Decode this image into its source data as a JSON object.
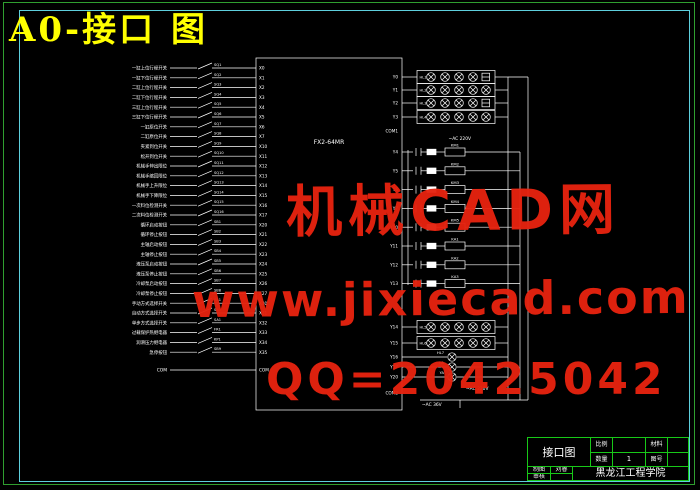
{
  "title": "A0-接口 图",
  "watermarks": {
    "line1": "机械CAD网",
    "line2": "www.jixiecad.com",
    "line3": "QQ=20425042"
  },
  "colors": {
    "border_outer": "#2f9e2f",
    "border_inner": "#5ecfdd",
    "title_yellow": "#ffff00",
    "schematic_white": "#ffffff",
    "watermark_red": "#e6230f",
    "titleblock_green": "#18c818"
  },
  "title_block": {
    "drawing_name": "接口图",
    "scale_label": "比例",
    "scale_value": "",
    "qty_label": "数量",
    "qty_value": "1",
    "material_label": "材料",
    "material_value": "",
    "dwgno_label": "图号",
    "dwgno_value": "",
    "drawn_label": "制图",
    "drawn_by": "刘睿",
    "checked_label": "审核",
    "school": "黑龙江工程学院"
  },
  "schematic": {
    "plc_model": "FX2-64MR",
    "com_input": "COM",
    "com_right_top": "COM1",
    "com_right_bottom": "COM2",
    "power_top": "~AC 220V",
    "power_mid": "~AC 220V",
    "power_bottom": "~AC 36V",
    "inputs": [
      {
        "label": "一缸上位行程开关",
        "dev": "SQ1",
        "pin": "X0"
      },
      {
        "label": "一缸下位行程开关",
        "dev": "SQ2",
        "pin": "X1"
      },
      {
        "label": "二缸上位行程开关",
        "dev": "SQ3",
        "pin": "X2"
      },
      {
        "label": "二缸下位行程开关",
        "dev": "SQ4",
        "pin": "X3"
      },
      {
        "label": "三缸上位行程开关",
        "dev": "SQ5",
        "pin": "X4"
      },
      {
        "label": "三缸下位行程开关",
        "dev": "SQ6",
        "pin": "X5"
      },
      {
        "label": "一缸原位开关",
        "dev": "SQ7",
        "pin": "X6"
      },
      {
        "label": "二缸原位开关",
        "dev": "SQ8",
        "pin": "X7"
      },
      {
        "label": "夹紧到位开关",
        "dev": "SQ9",
        "pin": "X10"
      },
      {
        "label": "松开到位开关",
        "dev": "SQ10",
        "pin": "X11"
      },
      {
        "label": "机械手伸出限位",
        "dev": "SQ11",
        "pin": "X12"
      },
      {
        "label": "机械手缩回限位",
        "dev": "SQ12",
        "pin": "X13"
      },
      {
        "label": "机械手上升限位",
        "dev": "SQ13",
        "pin": "X14"
      },
      {
        "label": "机械手下降限位",
        "dev": "SQ14",
        "pin": "X15"
      },
      {
        "label": "一次料位检测开关",
        "dev": "SQ15",
        "pin": "X16"
      },
      {
        "label": "二次料位检测开关",
        "dev": "SQ16",
        "pin": "X17"
      },
      {
        "label": "循环启动按钮",
        "dev": "SB1",
        "pin": "X20"
      },
      {
        "label": "循环停止按钮",
        "dev": "SB2",
        "pin": "X21"
      },
      {
        "label": "主轴启动按钮",
        "dev": "SB3",
        "pin": "X22"
      },
      {
        "label": "主轴停止按钮",
        "dev": "SB4",
        "pin": "X23"
      },
      {
        "label": "液压泵启动按钮",
        "dev": "SB5",
        "pin": "X24"
      },
      {
        "label": "液压泵停止按钮",
        "dev": "SB6",
        "pin": "X25"
      },
      {
        "label": "冷却泵启动按钮",
        "dev": "SB7",
        "pin": "X26"
      },
      {
        "label": "冷却泵停止按钮",
        "dev": "SB8",
        "pin": "X27"
      },
      {
        "label": "手动方式选择开关",
        "dev": "SA1",
        "pin": "X30"
      },
      {
        "label": "自动方式选择开关",
        "dev": "SA1",
        "pin": "X31"
      },
      {
        "label": "单步方式选择开关",
        "dev": "SA1",
        "pin": "X32"
      },
      {
        "label": "过载保护热继电器",
        "dev": "FR1",
        "pin": "X33"
      },
      {
        "label": "润滑压力继电器",
        "dev": "KP1",
        "pin": "X34"
      },
      {
        "label": "急停按钮",
        "dev": "SB9",
        "pin": "X35"
      }
    ],
    "lamp_rows_top": [
      {
        "pin": "Y0",
        "tag": "HL1"
      },
      {
        "pin": "Y1",
        "tag": "HL2"
      },
      {
        "pin": "Y2",
        "tag": "HL3"
      },
      {
        "pin": "Y3",
        "tag": "HL4"
      }
    ],
    "ladder": [
      {
        "pin": "Y4",
        "coil": "KM1"
      },
      {
        "pin": "Y5",
        "coil": "KM2"
      },
      {
        "pin": "Y6",
        "coil": "KM3"
      },
      {
        "pin": "Y7",
        "coil": "KM4"
      },
      {
        "pin": "Y10",
        "coil": "KM5"
      },
      {
        "pin": "Y11",
        "coil": "KA1"
      },
      {
        "pin": "Y12",
        "coil": "KA2"
      },
      {
        "pin": "Y13",
        "coil": "KA3"
      }
    ],
    "lamp_rows_bottom": [
      {
        "pin": "Y14",
        "tag": "HL5"
      },
      {
        "pin": "Y15",
        "tag": "HL6"
      }
    ],
    "singles": [
      {
        "pin": "Y16",
        "tag": "HL7"
      },
      {
        "pin": "Y17",
        "tag": "HA"
      },
      {
        "pin": "Y20",
        "tag": "YA"
      }
    ]
  }
}
